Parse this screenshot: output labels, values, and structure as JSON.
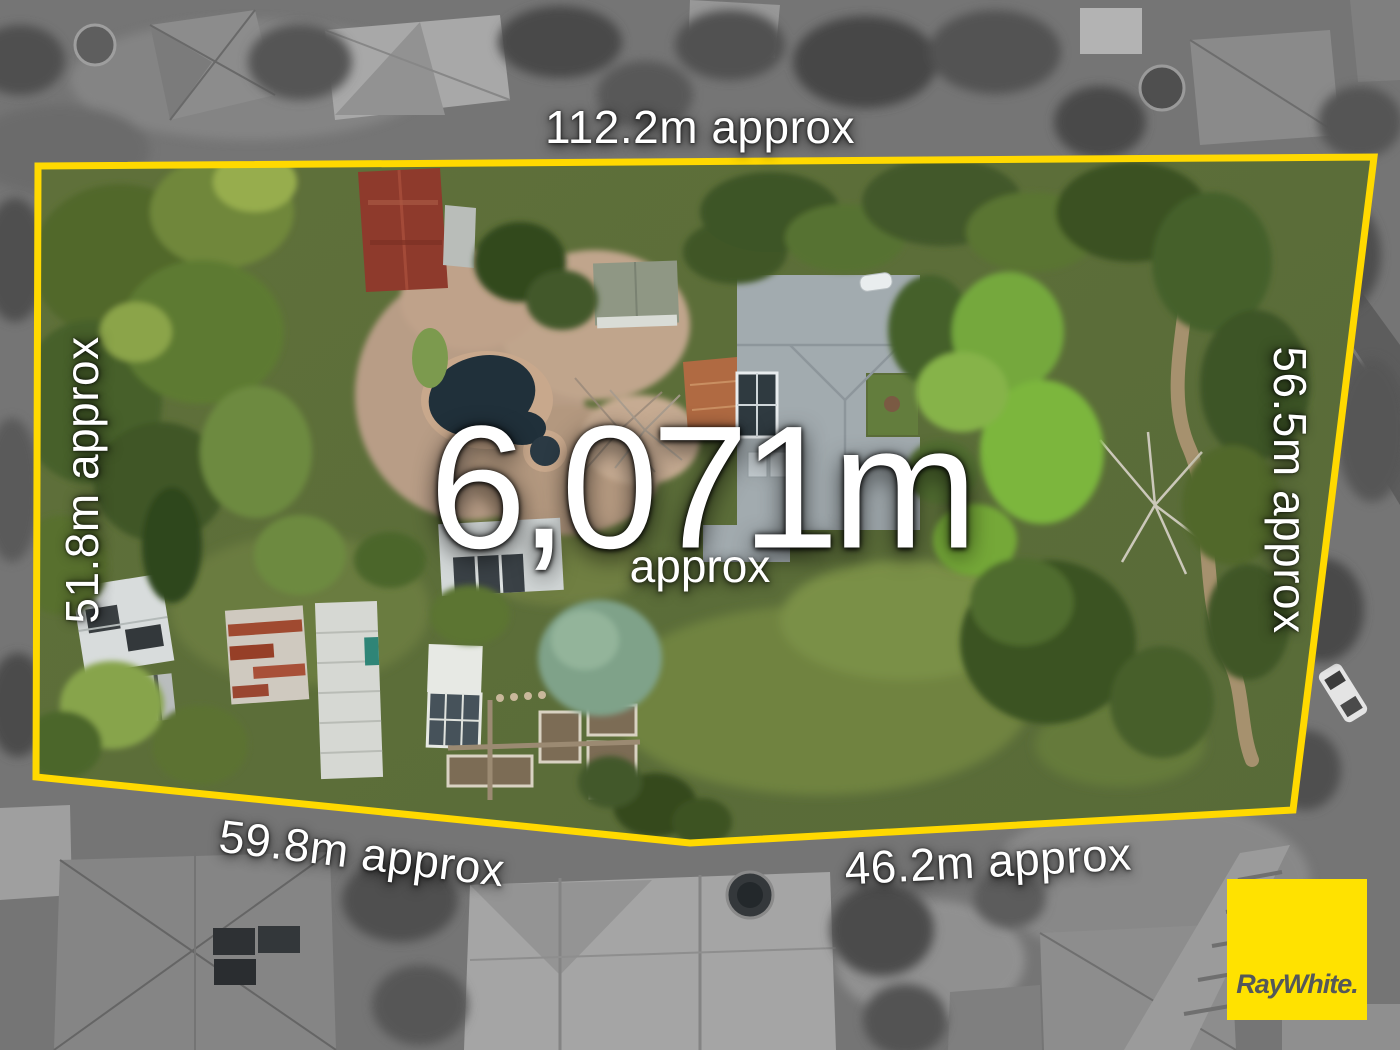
{
  "labels": {
    "top": "112.2m approx",
    "left": "51.8m approx",
    "right": "56.5m approx",
    "bottom_left": "59.8m approx",
    "bottom_right": "46.2m approx"
  },
  "area": {
    "value": "6,071m",
    "qualifier": "approx"
  },
  "logo": {
    "text": "RayWhite."
  },
  "colors": {
    "boundary_yellow": "#FFD900",
    "logo_yellow": "#FFE200",
    "logo_text_gray": "#54585A",
    "label_white": "#FFFFFF"
  }
}
